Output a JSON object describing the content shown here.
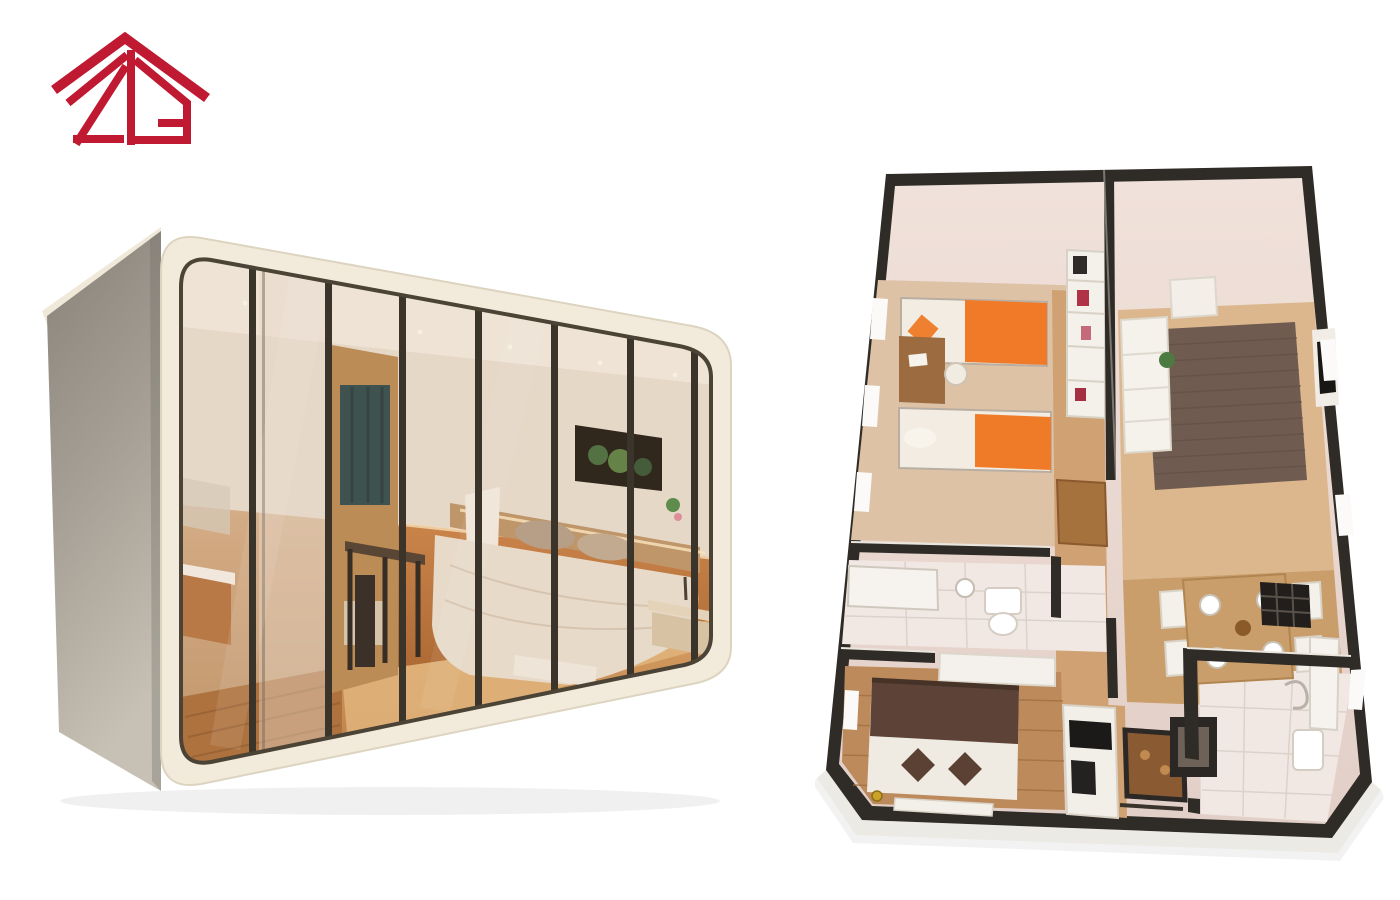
{
  "canvas": {
    "width": 1400,
    "height": 900,
    "background_color": "#ffffff"
  },
  "brand_logo": {
    "monogram": "2G",
    "symbol": "house-roof-monogram",
    "color": "#bf1a31",
    "aria_label": "2G house logo"
  },
  "pod_render": {
    "aria_label": "capsule house exterior render",
    "shell_color": "#f2ebdc",
    "side_panel_color": "#9b958b",
    "mullion_color": "#3a342b",
    "glass_panel_count": 8,
    "interior_elements": [
      "bathroom-vanity",
      "mirror",
      "sliding-door",
      "wardrobe",
      "desk",
      "chair",
      "bed",
      "pillows",
      "tv-window",
      "plant",
      "nightstand",
      "bench",
      "wood-floor"
    ],
    "interior_colors": {
      "floor": "#c98e52",
      "accent_wall": "#c27c3e",
      "bedding": "#ece5d7",
      "tv_frame": "#17140f",
      "wardrobe_wood": "#b98a50"
    }
  },
  "floor_plan_render": {
    "aria_label": "apartment 3D floor plan render",
    "wall_color": "#2f2b27",
    "wall_face_color": "#ead9d2",
    "accent_bedding_color": "#f07a28",
    "rug_color": "#6f5b50",
    "wood_floor_color": "#c99e6b",
    "tile_floor_color": "#f1e8e3",
    "master_bed_color": "#5d4337",
    "rooms": [
      {
        "name": "kids-bedroom",
        "position": "top-left"
      },
      {
        "name": "living-room",
        "position": "top-right"
      },
      {
        "name": "dining-area",
        "position": "center-right"
      },
      {
        "name": "bathroom-small",
        "position": "middle-left"
      },
      {
        "name": "master-bedroom",
        "position": "bottom-left"
      },
      {
        "name": "kitchen",
        "position": "bottom-center"
      },
      {
        "name": "bathroom-main",
        "position": "bottom-right"
      },
      {
        "name": "hallway",
        "position": "center"
      }
    ]
  }
}
